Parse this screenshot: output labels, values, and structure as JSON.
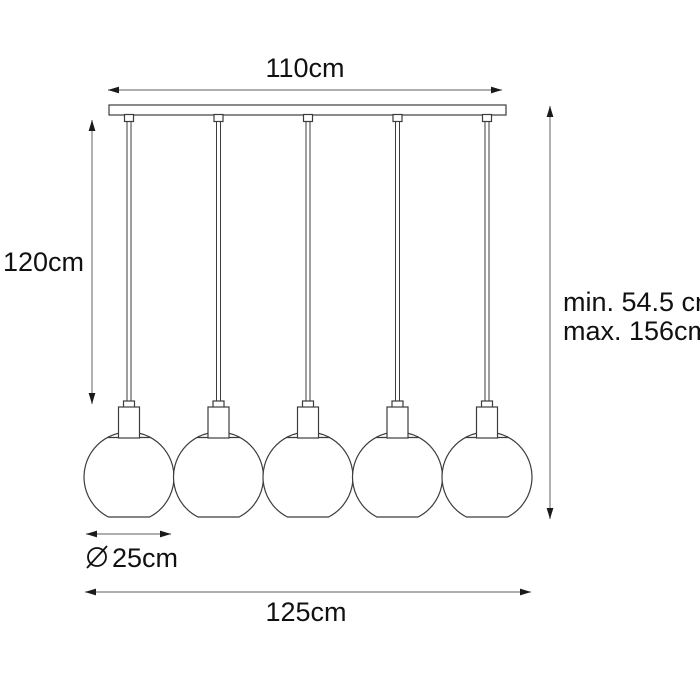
{
  "diagram": {
    "type": "product-dimension-drawing",
    "background": "#ffffff",
    "stroke_color": "#3c3c3c",
    "dimension_line_color": "#7d7d7d",
    "text_color": "#111111",
    "lamp": {
      "globe_count": 5,
      "parts": [
        "ceiling-bar",
        "cords",
        "sockets",
        "globe-shades"
      ]
    },
    "labels": {
      "bar_width": "110cm",
      "drop_length": "120cm",
      "height_min": "min. 54.5 cm",
      "height_max": "max. 156cm",
      "shade_diameter_symbol": "⌀",
      "shade_diameter": "25cm",
      "total_width": "125cm"
    }
  }
}
